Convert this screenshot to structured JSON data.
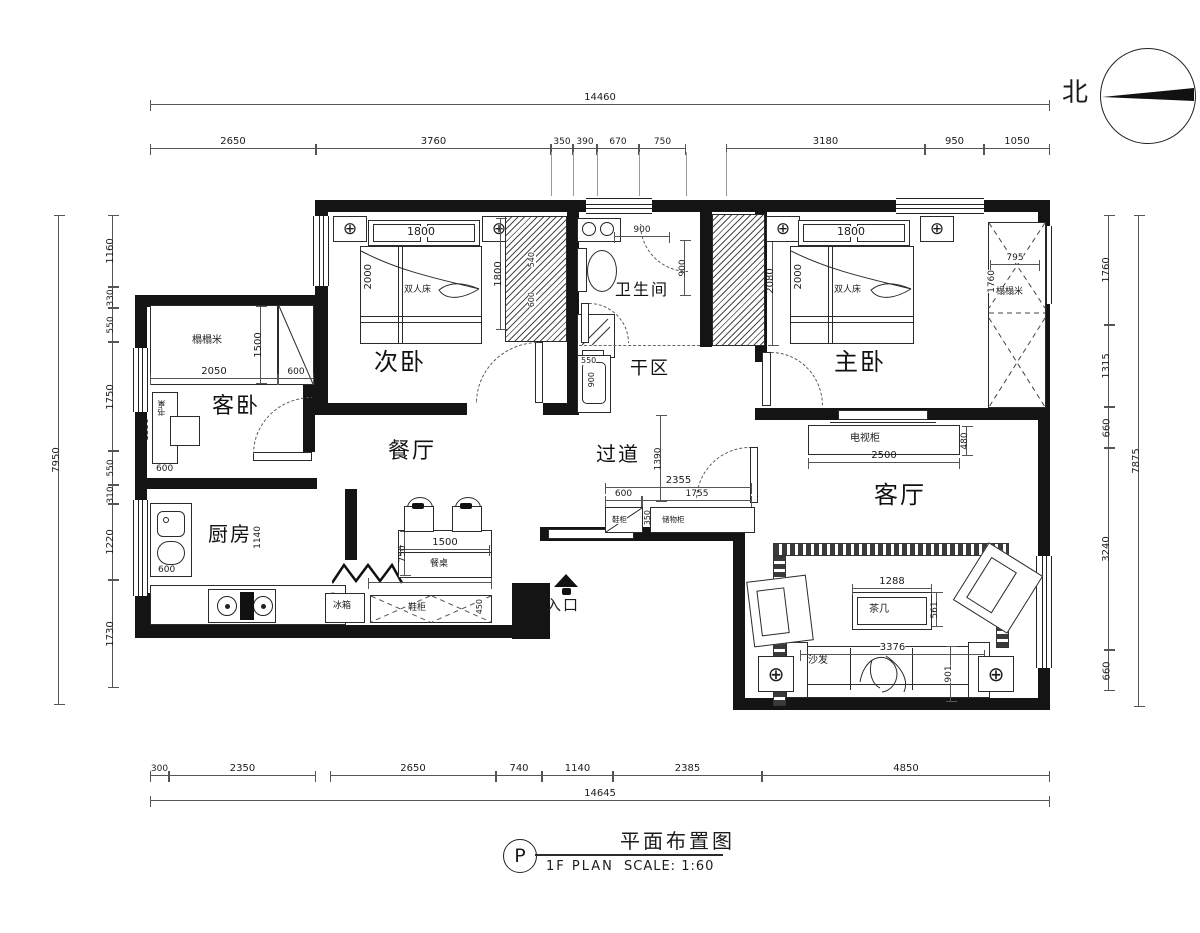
{
  "compass": {
    "north_label": "北"
  },
  "icons": {
    "column_marker": "⊕"
  },
  "dims": {
    "top": {
      "overall": "14460",
      "segments": [
        "2650",
        "3760",
        "350",
        "390",
        "670",
        "750",
        "3180",
        "950",
        "1050"
      ]
    },
    "bottom": {
      "overall": "14645",
      "segments": [
        "300",
        "2350",
        "2650",
        "740",
        "1140",
        "2385",
        "4850"
      ]
    },
    "left": {
      "overall": "7950",
      "segments": [
        "1160",
        "330",
        "550",
        "1750",
        "550",
        "310",
        "1220",
        "1730"
      ]
    },
    "right": {
      "overall": "7875",
      "segments": [
        "1760",
        "1315",
        "660",
        "3240",
        "660"
      ]
    }
  },
  "rooms": {
    "secondary_bedroom": "次卧",
    "bathroom": "卫生间",
    "dry_area": "干区",
    "master_bedroom": "主卧",
    "guest_bedroom": "客卧",
    "dining_room": "餐厅",
    "hallway": "过道",
    "living_room": "客厅",
    "kitchen": "厨房",
    "entrance": "入口"
  },
  "secondary_bedroom": {
    "bed_label": "双人床",
    "bed_width": "1800",
    "bed_length": "2000",
    "wardrobe_height": "1800",
    "wardrobe_d1": "540",
    "wardrobe_d2": "600"
  },
  "master_bedroom": {
    "bed_label": "双人床",
    "bed_width": "1800",
    "bed_length": "2000",
    "tatami_label": "榻榻米",
    "tatami_width": "795",
    "tatami_height": "1760",
    "wardrobe_height": "2080"
  },
  "bathroom": {
    "shower_width": "900",
    "shower_depth": "900",
    "sink_width": "550",
    "sink_depth": "900"
  },
  "guest_bedroom": {
    "tatami_label": "榻榻米",
    "tatami_width": "2050",
    "tatami_depth": "1500",
    "wardrobe_width": "600",
    "desk_label": "书桌",
    "desk_length": "1350",
    "desk_width": "600"
  },
  "kitchen": {
    "sink_width": "600",
    "counter_depth": "600",
    "aisle": "1140",
    "fridge_label": "冰箱"
  },
  "dining": {
    "table_label": "餐桌",
    "table_width": "1500",
    "table_depth": "750",
    "cabinet_run": "2000",
    "shoe_cabinet_label": "鞋柜",
    "shoe_cabinet_depth": "450"
  },
  "hallway": {
    "width": "1390",
    "cabinet_total": "2355",
    "cabinet_seg1": "600",
    "cabinet_seg2": "1755",
    "cabinet_depth": "350",
    "cabinet1_label": "鞋柜",
    "cabinet2_label": "储物柜"
  },
  "living": {
    "tv_cabinet_label": "电视柜",
    "tv_cabinet_width": "2500",
    "tv_cabinet_depth": "480",
    "coffee_table_label": "茶几",
    "coffee_table_width": "1288",
    "coffee_table_depth": "561",
    "sofa_label": "沙发",
    "sofa_width": "3376",
    "sofa_depth": "901"
  },
  "titleblock": {
    "bubble": "P",
    "name": "平面布置图",
    "plan": "1F PLAN",
    "scale": "SCALE: 1:60"
  }
}
